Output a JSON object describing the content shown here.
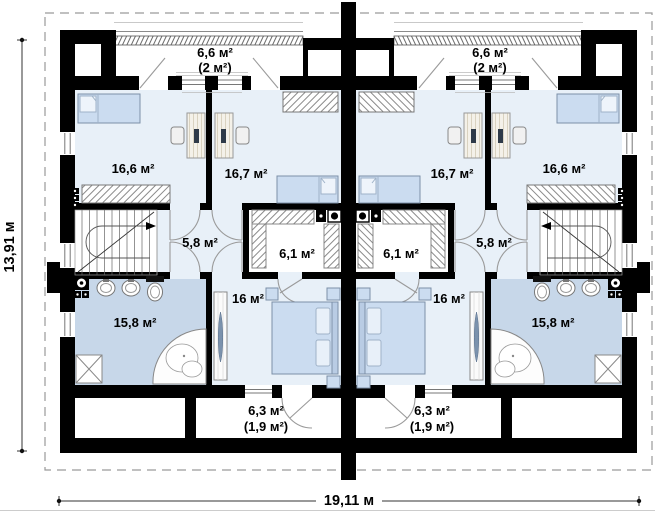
{
  "floor_plan": {
    "dimensions": {
      "height": "13,91 м",
      "width": "19,11 м"
    },
    "labels": {
      "left": {
        "bedroom1": "16,6 м²",
        "bedroom2": "16,7 м²",
        "hall": "5,8 м²",
        "closet": "6,1 м²",
        "bathroom": "15,8 м²",
        "bedroom3": "16 м²",
        "balcony_top_area": "6,6 м²",
        "balcony_top_usable": "(2 м²)",
        "balcony_bottom_area": "6,3 м²",
        "balcony_bottom_usable": "(1,9 м²)"
      },
      "right": {
        "bedroom1": "16,6 м²",
        "bedroom2": "16,7 м²",
        "hall": "5,8 м²",
        "closet": "6,1 м²",
        "bathroom": "15,8 м²",
        "bedroom3": "16 м²",
        "balcony_top_area": "6,6 м²",
        "balcony_top_usable": "(2 м²)",
        "balcony_bottom_area": "6,3 м²",
        "balcony_bottom_usable": "(1,9 м²)"
      }
    },
    "colors": {
      "walls": "#000000",
      "floor": "#e8f0f8",
      "wet_room_floor": "#c7d7e9",
      "furniture": "#cbdcf0",
      "roof_outline": "#9a9a9a"
    }
  }
}
